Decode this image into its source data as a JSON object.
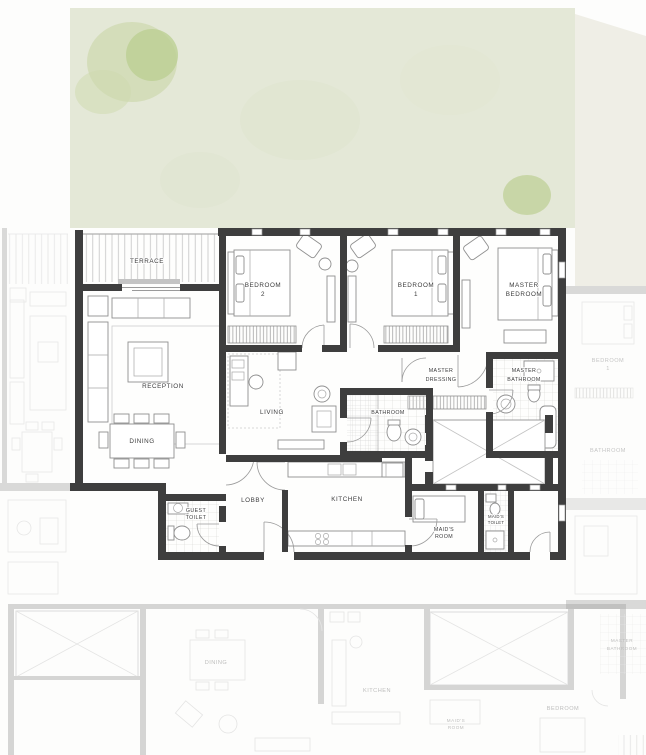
{
  "rooms": {
    "terrace": {
      "label": "TERRACE"
    },
    "reception": {
      "label": "RECEPTION"
    },
    "dining": {
      "label": "DINING"
    },
    "bedroom2": {
      "line1": "BEDROOM",
      "line2": "2"
    },
    "bedroom1": {
      "line1": "BEDROOM",
      "line2": "1"
    },
    "master_bedroom": {
      "line1": "MASTER",
      "line2": "BEDROOM"
    },
    "living": {
      "label": "LIVING"
    },
    "master_dressing": {
      "line1": "MASTER",
      "line2": "DRESSING"
    },
    "master_bathroom": {
      "line1": "MASTER",
      "line2": "BATHROOM"
    },
    "bathroom": {
      "label": "BATHROOM"
    },
    "kitchen": {
      "label": "KITCHEN"
    },
    "lobby": {
      "label": "LOBBY"
    },
    "guest_toilet": {
      "line1": "GUEST",
      "line2": "TOILET"
    },
    "maids_room": {
      "line1": "MAID'S",
      "line2": "ROOM"
    },
    "maids_toilet": {
      "line1": "MAID'S",
      "line2": "TOILET"
    }
  },
  "neighbors": {
    "right_bedroom": {
      "line1": "BEDROOM",
      "line2": "1"
    },
    "right_bathroom": {
      "label": "BATHROOM"
    },
    "bottom_dining": {
      "label": "DINING"
    },
    "bottom_kitchen": {
      "label": "KITCHEN"
    },
    "bottom_maids_room": {
      "line1": "MAID'S",
      "line2": "ROOM"
    },
    "bottom_bedroom": {
      "label": "BEDROOM"
    },
    "bottom_master_bathroom": {
      "line1": "MASTER",
      "line2": "BATHROOM"
    }
  },
  "colors": {
    "wall": "#3e3e3e",
    "garden": "#e4e8d7",
    "garden_edge": "#efeee6",
    "garden_mid": "#cdd9ae",
    "garden_dark": "#bccf93",
    "paper": "#fdfdfc",
    "line": "#8f8f8f",
    "faint": "#c6c6c6",
    "label": "#3b3b3b"
  }
}
